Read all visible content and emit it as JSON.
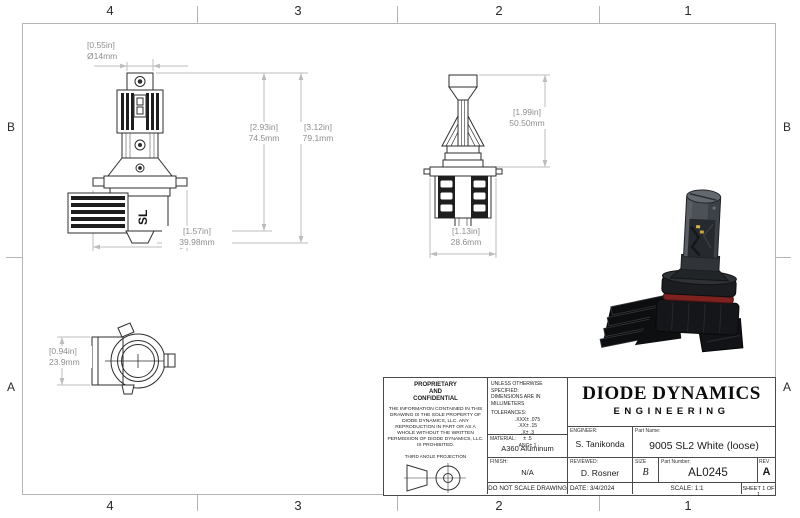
{
  "sheet": {
    "zones_top": [
      "4",
      "3",
      "2",
      "1"
    ],
    "zones_bottom": [
      "4",
      "3",
      "2",
      "1"
    ],
    "zones_left": [
      "B",
      "A"
    ],
    "zones_right": [
      "B",
      "A"
    ]
  },
  "views": {
    "front": {
      "marking": "SL",
      "dims": {
        "diameter_in": "[0.55in]",
        "diameter_mm": "Ø14mm",
        "height_body_in": "[2.93in]",
        "height_body_mm": "74.5mm",
        "height_total_in": "[3.12in]",
        "height_total_mm": "79.1mm",
        "width_in": "[1.57in]",
        "width_mm": "39.98mm"
      }
    },
    "side": {
      "dims": {
        "height_upper_in": "[1.99in]",
        "height_upper_mm": "50.50mm",
        "width_in": "[1.13in]",
        "width_mm": "28.6mm"
      }
    },
    "top": {
      "dims": {
        "height_in": "[0.94in]",
        "height_mm": "23.9mm"
      }
    }
  },
  "title_block": {
    "proprietary": {
      "title_line1": "PROPRIETARY",
      "title_line2": "AND",
      "title_line3": "CONFIDENTIAL",
      "body": "THE INFORMATION CONTAINED IN THIS DRAWING IS THE SOLE PROPERTY OF DIODE DYNAMICS, LLC.  ANY REPRODUCTION IN PART OR AS A WHOLE WITHOUT THE WRITTEN PERMISSION OF DIODE DYNAMICS, LLC. IS PROHIBITED.",
      "projection_label": "THIRD ANGLE PROJECTION"
    },
    "specs": {
      "line1": "UNLESS OTHERWISE SPECIFIED:",
      "line2": "DIMENSIONS ARE IN MILLIMETERS",
      "tolerances_label": "TOLERANCES:",
      "tolerances": [
        ".XXX± .075",
        ".XX± .15",
        ".X± .3",
        "± .5",
        "ANG± 1"
      ],
      "material_label": "MATERIAL:",
      "material": "A360 Aluminum",
      "finish_label": "FINISH:",
      "finish": "N/A",
      "do_not_scale": "DO NOT SCALE DRAWING"
    },
    "company": {
      "name": "DIODE DYNAMICS",
      "division": "ENGINEERING"
    },
    "fields": {
      "engineer_label": "ENGINEER:",
      "engineer": "S. Tanikonda",
      "part_name_label": "Part Name:",
      "part_name": "9005 SL2 White (loose)",
      "reviewed_label": "REVIEWED:",
      "reviewed": "D. Rosner",
      "size_label": "SIZE",
      "size": "B",
      "part_number_label": "Part Number:",
      "part_number": "AL0245",
      "rev_label": "REV",
      "rev": "A",
      "date_label": "DATE:",
      "date": "3/4/2024",
      "scale": "SCALE: 1:1",
      "sheet": "SHEET 1 OF 1"
    }
  },
  "colors": {
    "accent_oring": "#7e2220",
    "line": "#b5b5b5",
    "draw": "#2e2e2e"
  }
}
